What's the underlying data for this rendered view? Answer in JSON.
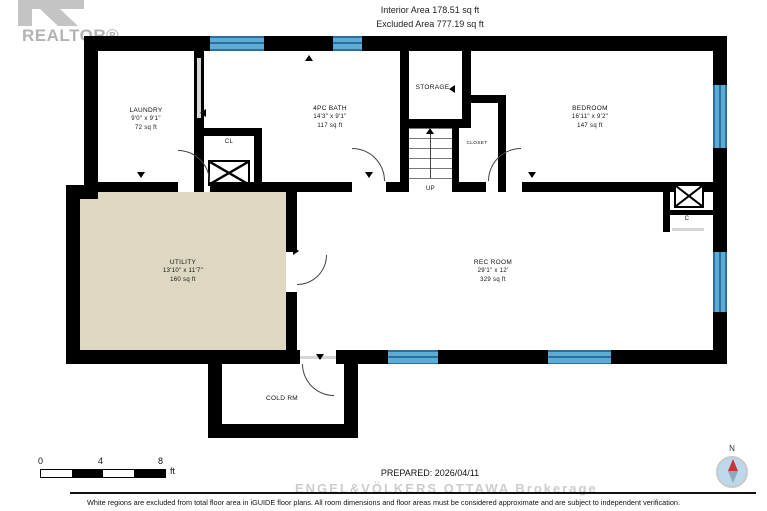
{
  "branding": {
    "realtor_logo_text": "REALTOR®"
  },
  "areas": {
    "interior": "Interior Area 178.51 sq ft",
    "excluded": "Excluded Area 777.19 sq ft"
  },
  "rooms": {
    "laundry": {
      "name": "LAUNDRY",
      "dims": "9'0\" x 9'1\"",
      "area": "72 sq ft"
    },
    "bath": {
      "name": "4PC BATH",
      "dims": "14'3\" x 9'1\"",
      "area": "117 sq ft"
    },
    "storage": {
      "name": "STORAGE"
    },
    "bedroom": {
      "name": "BEDROOM",
      "dims": "16'11\" x 9'2\"",
      "area": "147 sq ft"
    },
    "utility": {
      "name": "UTILITY",
      "dims": "13'10\" x 11'7\"",
      "area": "160 sq ft"
    },
    "rec_room": {
      "name": "REC ROOM",
      "dims": "29'1\" x 12'",
      "area": "329 sq ft"
    },
    "cold_room": {
      "name": "COLD RM"
    },
    "closet": {
      "name": "CLOSET"
    },
    "cl": {
      "name": "CL"
    },
    "c": {
      "name": "C"
    },
    "stairs_up": {
      "name": "UP"
    }
  },
  "scale_bar": {
    "tick0": "0",
    "tick1": "4",
    "tick2": "8",
    "unit": "ft"
  },
  "footer": {
    "prepared": "PREPARED: 2026/04/11",
    "watermark": "ENGEL&VÖLKERS OTTAWA Brokerage",
    "disclaimer": "White regions are excluded from total floor area in iGUIDE floor plans. All room dimensions and floor areas must be considered approximate and are subject to independent verification."
  },
  "compass": {
    "north_label": "N"
  },
  "colors": {
    "wall": "#000000",
    "window_fill": "#5bacd6",
    "window_line": "#2a6f9e",
    "utility_fill": "#ded7c2",
    "excluded_fill": "#ffffff",
    "compass_needle_red": "#cf3333",
    "compass_needle_gray": "#8fa8bc",
    "logo_gray": "#b3b3b3",
    "watermark_gray": "#cccccc"
  }
}
